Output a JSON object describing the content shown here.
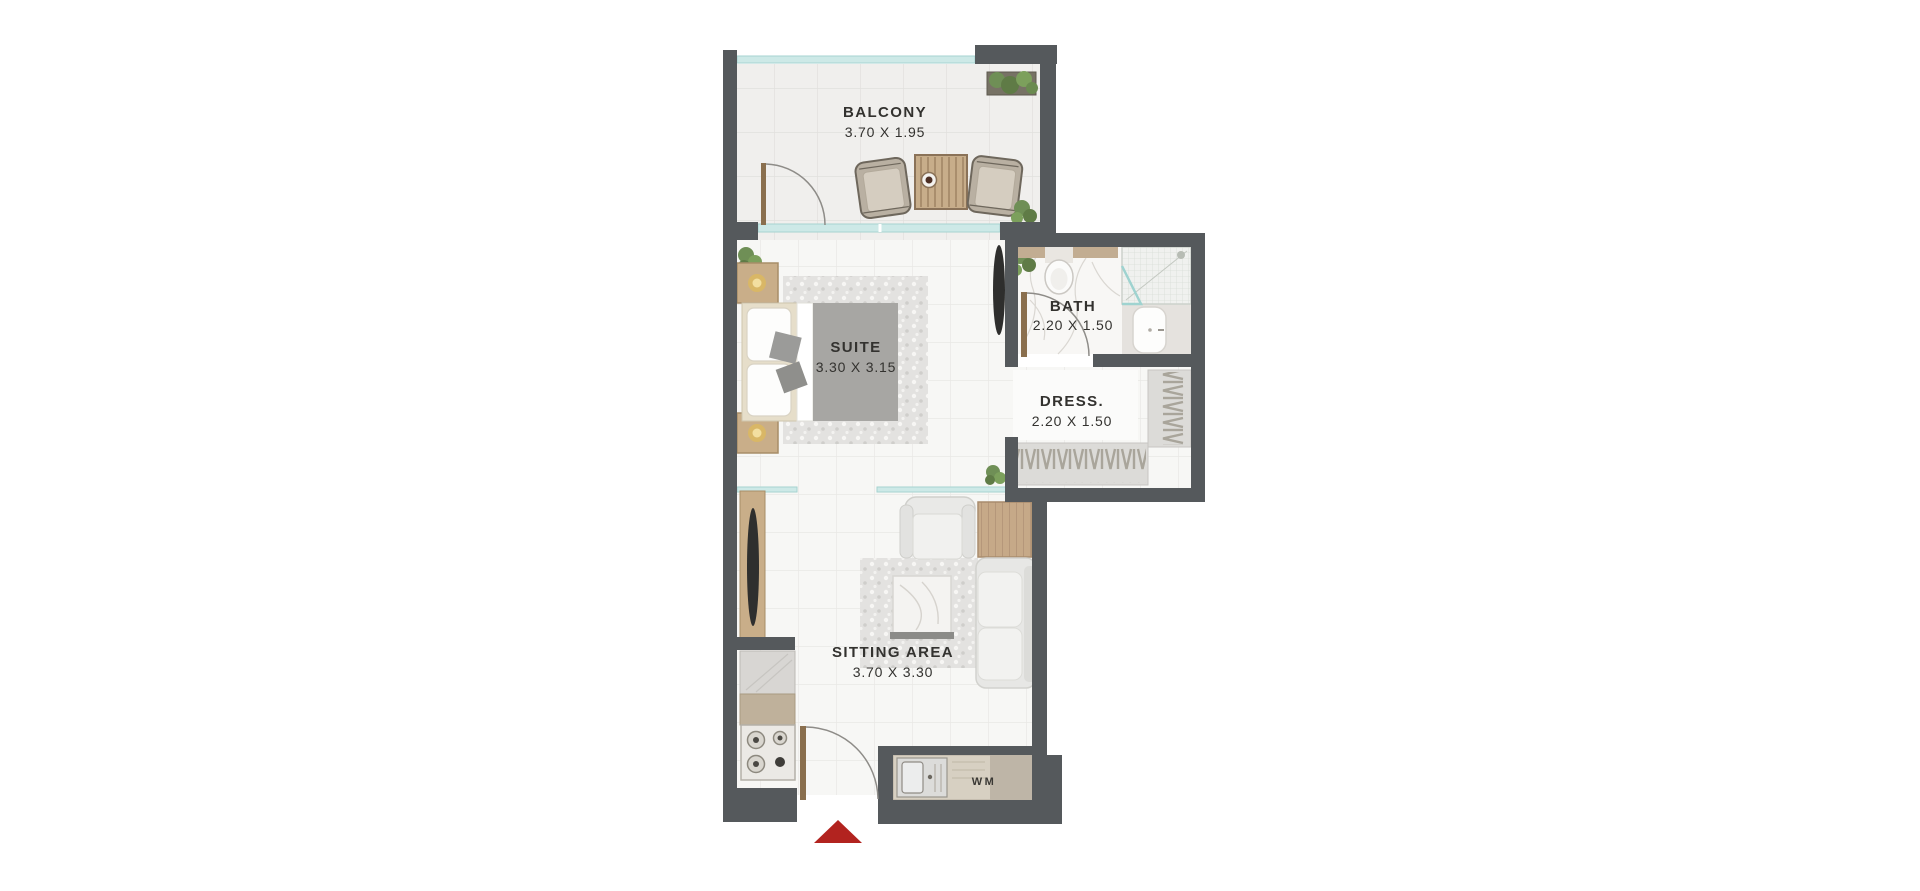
{
  "rooms": {
    "balcony": {
      "name": "BALCONY",
      "dims": "3.70 X 1.95"
    },
    "suite": {
      "name": "SUITE",
      "dims": "3.30 X 3.15"
    },
    "bath": {
      "name": "BATH",
      "dims": "2.20 X 1.50"
    },
    "dress": {
      "name": "DRESS.",
      "dims": "2.20 X 1.50"
    },
    "sitting_area": {
      "name": "SITTING AREA",
      "dims": "3.70 X 3.30"
    }
  },
  "appliances": {
    "washing_machine_label": "WM"
  },
  "icons": {
    "entry_marker": "red-triangle-entry-arrow",
    "door_swings": "quarter-arc-door-swing",
    "hanger_racks": "wardrobe-hanger-zigzag"
  },
  "colors": {
    "wall": "#55595c",
    "glass": "#c6e4e2",
    "wood": "#c9ae89",
    "duvet_gray": "#a7a6a3",
    "floor": "#f7f7f5",
    "entry_marker_red": "#b2231f",
    "text": "#33322f"
  }
}
